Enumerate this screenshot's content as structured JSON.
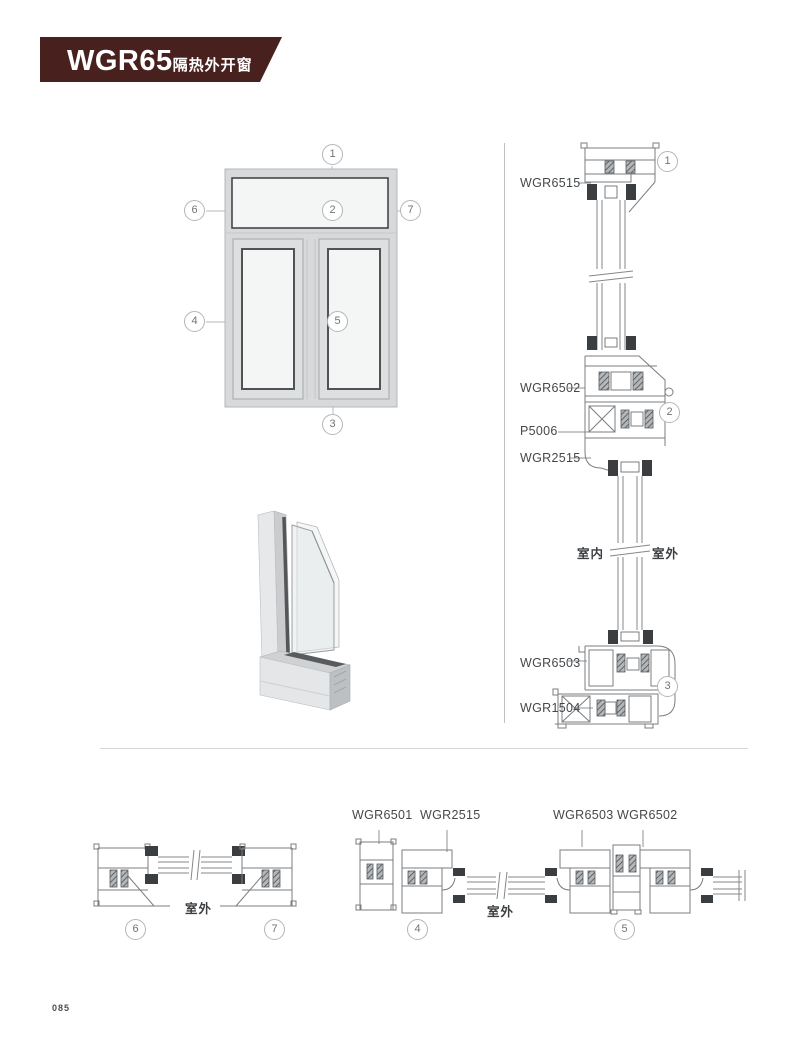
{
  "header": {
    "title": "WGR65",
    "subtitle": "隔热外开窗",
    "banner_color": "#48211f"
  },
  "elevation": {
    "callouts": [
      {
        "label": "1"
      },
      {
        "label": "2"
      },
      {
        "label": "3"
      },
      {
        "label": "4"
      },
      {
        "label": "5"
      },
      {
        "label": "6"
      },
      {
        "label": "7"
      }
    ]
  },
  "vertical_section": {
    "labels": [
      {
        "text": "WGR6515"
      },
      {
        "text": "WGR6502"
      },
      {
        "text": "P5006"
      },
      {
        "text": "WGR2515"
      },
      {
        "text": "WGR6503"
      },
      {
        "text": "WGR1504"
      }
    ],
    "callouts": [
      {
        "label": "1"
      },
      {
        "label": "2"
      },
      {
        "label": "3"
      }
    ],
    "indoor_label": "室内",
    "outdoor_label": "室外"
  },
  "bottom_left_section": {
    "outdoor_label": "室外",
    "callouts": [
      {
        "label": "6"
      },
      {
        "label": "7"
      }
    ]
  },
  "bottom_right_section": {
    "labels": [
      {
        "text": "WGR6501"
      },
      {
        "text": "WGR2515"
      },
      {
        "text": "WGR6503"
      },
      {
        "text": "WGR6502"
      }
    ],
    "outdoor_label": "室外",
    "callouts": [
      {
        "label": "4"
      },
      {
        "label": "5"
      }
    ]
  },
  "page": {
    "number": "085"
  },
  "colors": {
    "banner": "#48211f",
    "drawing_line": "#7a7d80",
    "gasket_fill": "#3b3e41",
    "label_text": "#45484b",
    "callout_border": "#b3b6b8"
  }
}
